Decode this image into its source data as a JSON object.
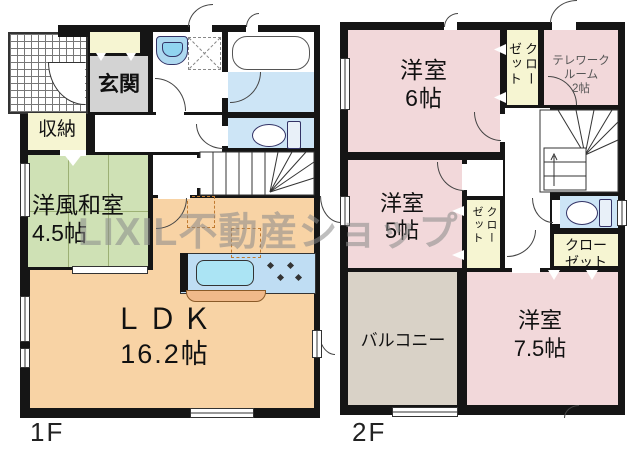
{
  "watermark": "LIXIL不動産ショップ",
  "palette": {
    "wall": "#151515",
    "western_room_pink": "#f2d8da",
    "japanese_room_green": "#cfe1b5",
    "ldk_peach": "#f8d3a5",
    "closet_cream": "#f6f5d2",
    "entrance_gray": "#d3d3d3",
    "wet_area_blue": "#cde5f6",
    "balcony_beige": "#d9d2c7",
    "accent_dashed_orange": "#c07a30"
  },
  "floor1": {
    "floor_label": "1F",
    "genkan": "玄関",
    "storage": "収納",
    "washitsu_name": "洋風和室",
    "washitsu_size": "4.5帖",
    "ldk_name": "ＬＤＫ",
    "ldk_size": "16.2帖"
  },
  "floor2": {
    "floor_label": "2F",
    "west6_name": "洋室",
    "west6_size": "6帖",
    "closet_top": "クローゼット",
    "telework_line1": "テレワーク",
    "telework_line2": "ルーム",
    "telework_size": "2帖",
    "west5_name": "洋室",
    "west5_size": "5帖",
    "closet_west5": "クローゼット",
    "closet_hall": "クローゼット",
    "balcony": "バルコニー",
    "west75_name": "洋室",
    "west75_size": "7.5帖"
  }
}
